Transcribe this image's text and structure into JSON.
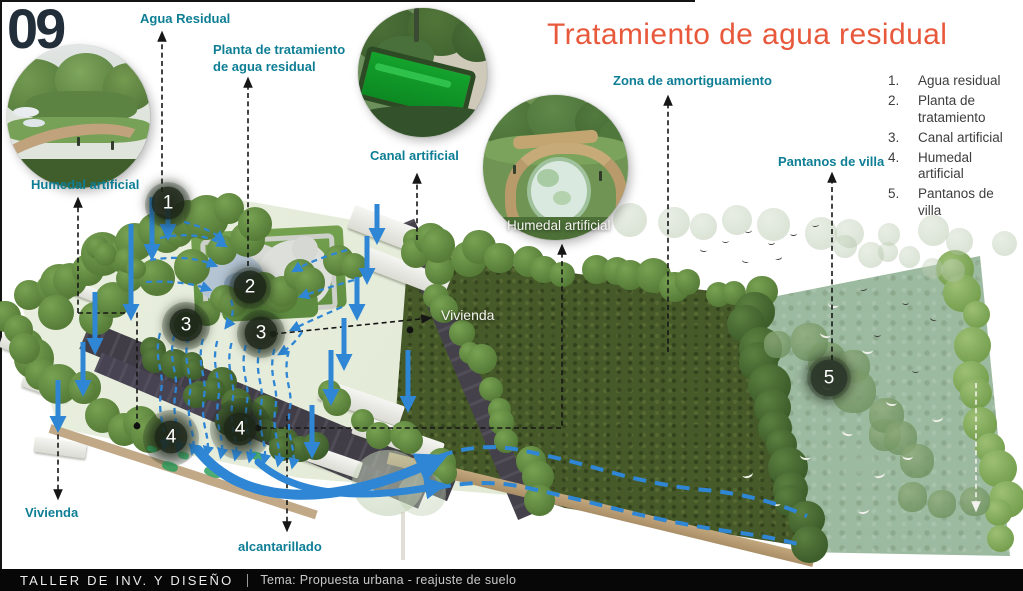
{
  "slide": {
    "number": "09",
    "title": "Tratamiento de agua residual"
  },
  "legend": {
    "items": [
      {
        "num": "1.",
        "label": "Agua residual"
      },
      {
        "num": "2.",
        "label": "Planta de tratamiento"
      },
      {
        "num": "3.",
        "label": "Canal artificial"
      },
      {
        "num": "4.",
        "label": "Humedal artificial"
      },
      {
        "num": "5.",
        "label": "Pantanos de villa"
      }
    ]
  },
  "callouts": {
    "agua_residual": "Agua Residual",
    "planta_line1": "Planta de tratamiento",
    "planta_line2": "de agua residual",
    "canal": "Canal artificial",
    "humedal_left": "Humedal artificial",
    "humedal_center": "Humedal artificial",
    "zona": "Zona de amortiguamiento",
    "pantanos": "Pantanos de villa",
    "vivienda_center": "Vivienda",
    "vivienda_left": "Vivienda",
    "alcantarillado": "alcantarillado"
  },
  "markers": {
    "m1": "1",
    "m2": "2",
    "m3a": "3",
    "m3b": "3",
    "m4a": "4",
    "m4b": "4",
    "m5": "5"
  },
  "footer": {
    "left": "TALLER DE INV. Y DISEÑO",
    "right": "Tema: Propuesta urbana  - reajuste de suelo"
  },
  "colors": {
    "title_orange": "#E8593C",
    "label_teal": "#0E7E95",
    "flow_blue": "#2E86D4",
    "slide_number": "#222F3A",
    "footer_bg": "#070707"
  }
}
